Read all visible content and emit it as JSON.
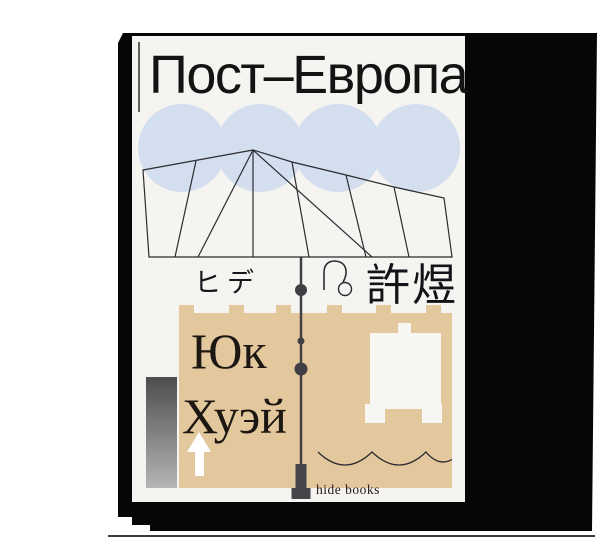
{
  "cover": {
    "title": "Пост–Европа",
    "author_katakana": "ヒデ",
    "author_chinese": "許煜",
    "author_cyrillic_first": "Юк",
    "author_cyrillic_last": "Хуэй",
    "publisher": "hide books"
  },
  "colors": {
    "backdrop": "#060606",
    "cover_paper": "#f6f4f1",
    "circles": "#d3dfef",
    "tan_shape": "#e3c89d",
    "line_art": "#2b2b31",
    "pole": "#45454a",
    "ink": "#1c1712",
    "arrow": "#ffffff",
    "gradient_bar_top": "#4d4d4d",
    "gradient_bar_bottom": "#b5b5b5"
  },
  "artwork": {
    "circle_count": 4,
    "crenellation_tab_count": 6,
    "scallop_wave_count": 3
  }
}
